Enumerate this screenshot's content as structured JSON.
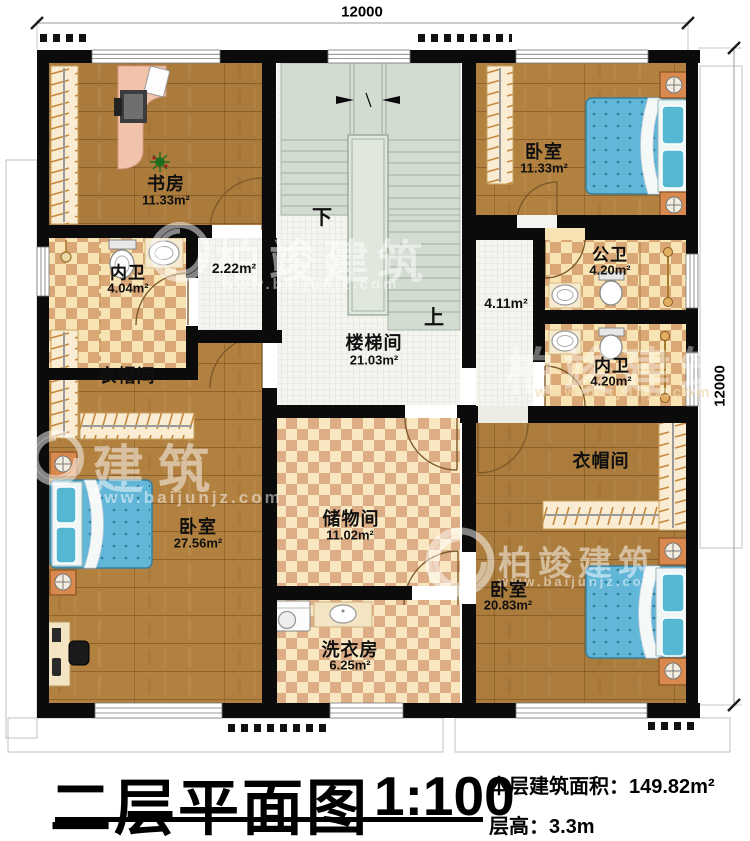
{
  "dimensions": {
    "top": "12000",
    "right": "12000"
  },
  "stairs": {
    "down_label": "下",
    "up_label": "上"
  },
  "watermark": {
    "brand": "柏竣建筑",
    "brand_partial": "建筑",
    "url": "www.baijunjz.com"
  },
  "rooms": {
    "study": {
      "name": "书房",
      "area": "11.33m²"
    },
    "bedroom_top_right": {
      "name": "卧室",
      "area": "11.33m²"
    },
    "bath_inner_left": {
      "name": "内卫",
      "area": "4.04m²"
    },
    "corridor": {
      "area": "2.22m²"
    },
    "bath_public": {
      "name": "公卫",
      "area": "4.20m²"
    },
    "hall": {
      "area": "4.11m²"
    },
    "stairwell": {
      "name": "楼梯间",
      "area": "21.03m²"
    },
    "bath_inner_right": {
      "name": "内卫",
      "area": "4.20m²"
    },
    "cloakroom_left": {
      "name": "衣帽间"
    },
    "bedroom_left": {
      "name": "卧室",
      "area": "27.56m²"
    },
    "storage": {
      "name": "储物间",
      "area": "11.02m²"
    },
    "laundry": {
      "name": "洗衣房",
      "area": "6.25m²"
    },
    "cloakroom_right": {
      "name": "衣帽间"
    },
    "bedroom_bottom_right": {
      "name": "卧室",
      "area": "20.83m²"
    }
  },
  "title_block": {
    "title": "二层平面图",
    "scale": "1:100",
    "area_label": "本层建筑面积：",
    "area_value": "149.82m²",
    "floor_height_label": "层高：",
    "floor_height_value": "3.3m"
  }
}
